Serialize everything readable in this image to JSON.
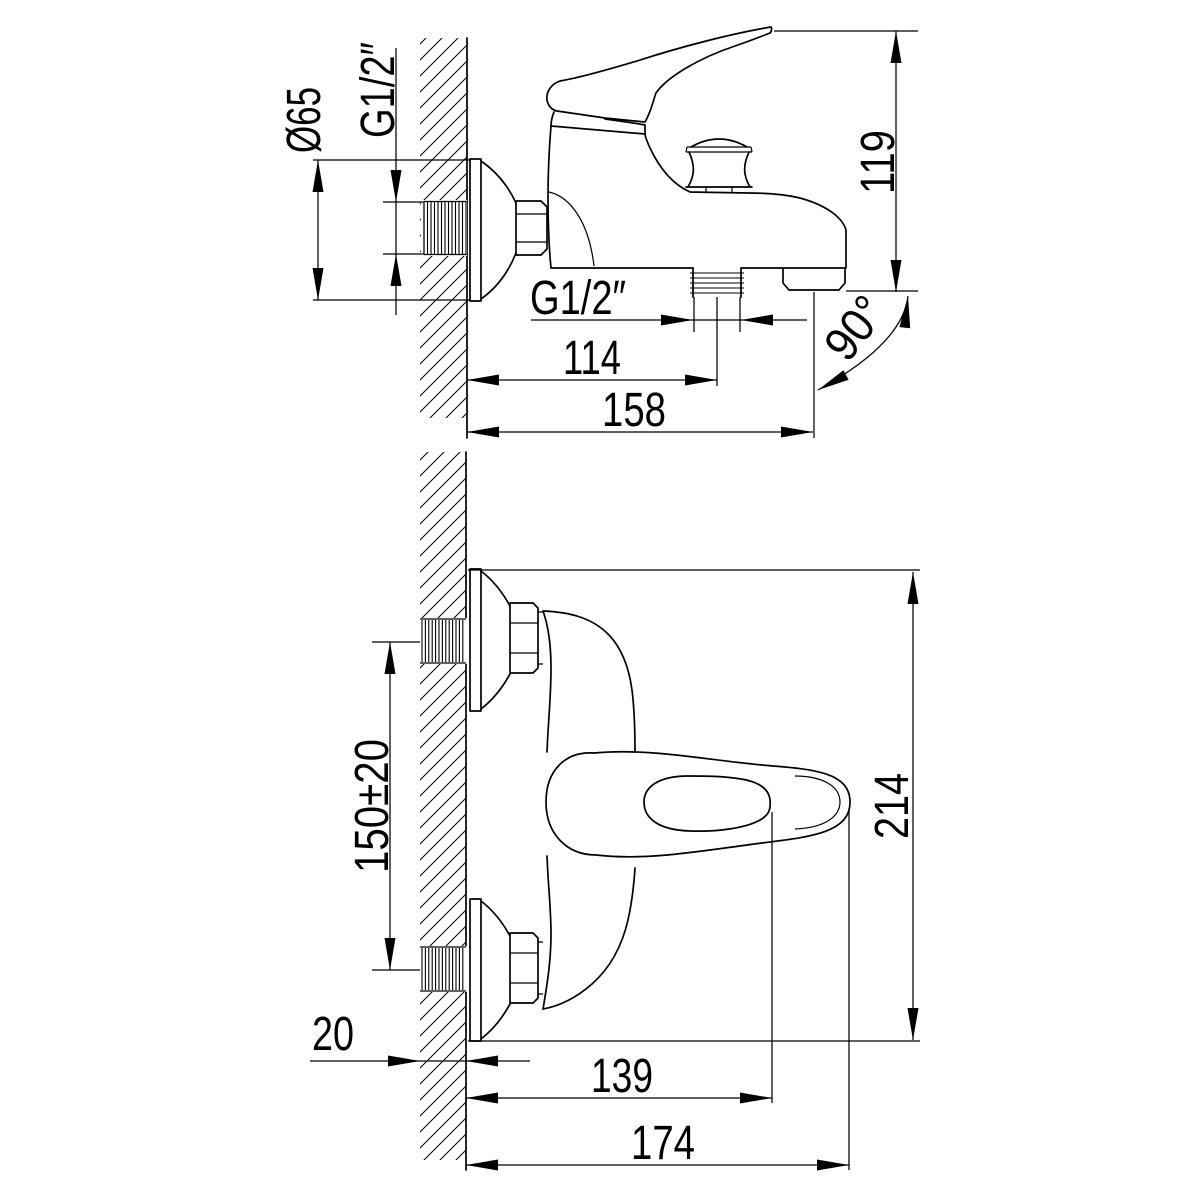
{
  "drawing": {
    "type": "technical-dimension-drawing",
    "subject": "wall-mounted single-lever bath and shower mixer, two projection views with installation dimensions",
    "units": "mm",
    "colors": {
      "line": "#000000",
      "background": "#ffffff"
    },
    "views": {
      "side_view": {
        "name": "side view (section through wall)",
        "dimensions": {
          "escutcheon_diameter": "Ø65",
          "wall_connection_thread": "G1/2″",
          "overall_height": "119",
          "shower_outlet_thread": "G1/2″",
          "wall_to_shower_outlet": "114",
          "wall_to_spout_end": "158",
          "spout_outlet_angle": "90°"
        }
      },
      "top_view": {
        "name": "top view (plan against wall)",
        "dimensions": {
          "connection_centres_spacing": "150±20",
          "overall_width": "214",
          "wall_thickness": "20",
          "wall_to_grip_end": "139",
          "wall_to_handle_tip": "174"
        }
      }
    }
  }
}
